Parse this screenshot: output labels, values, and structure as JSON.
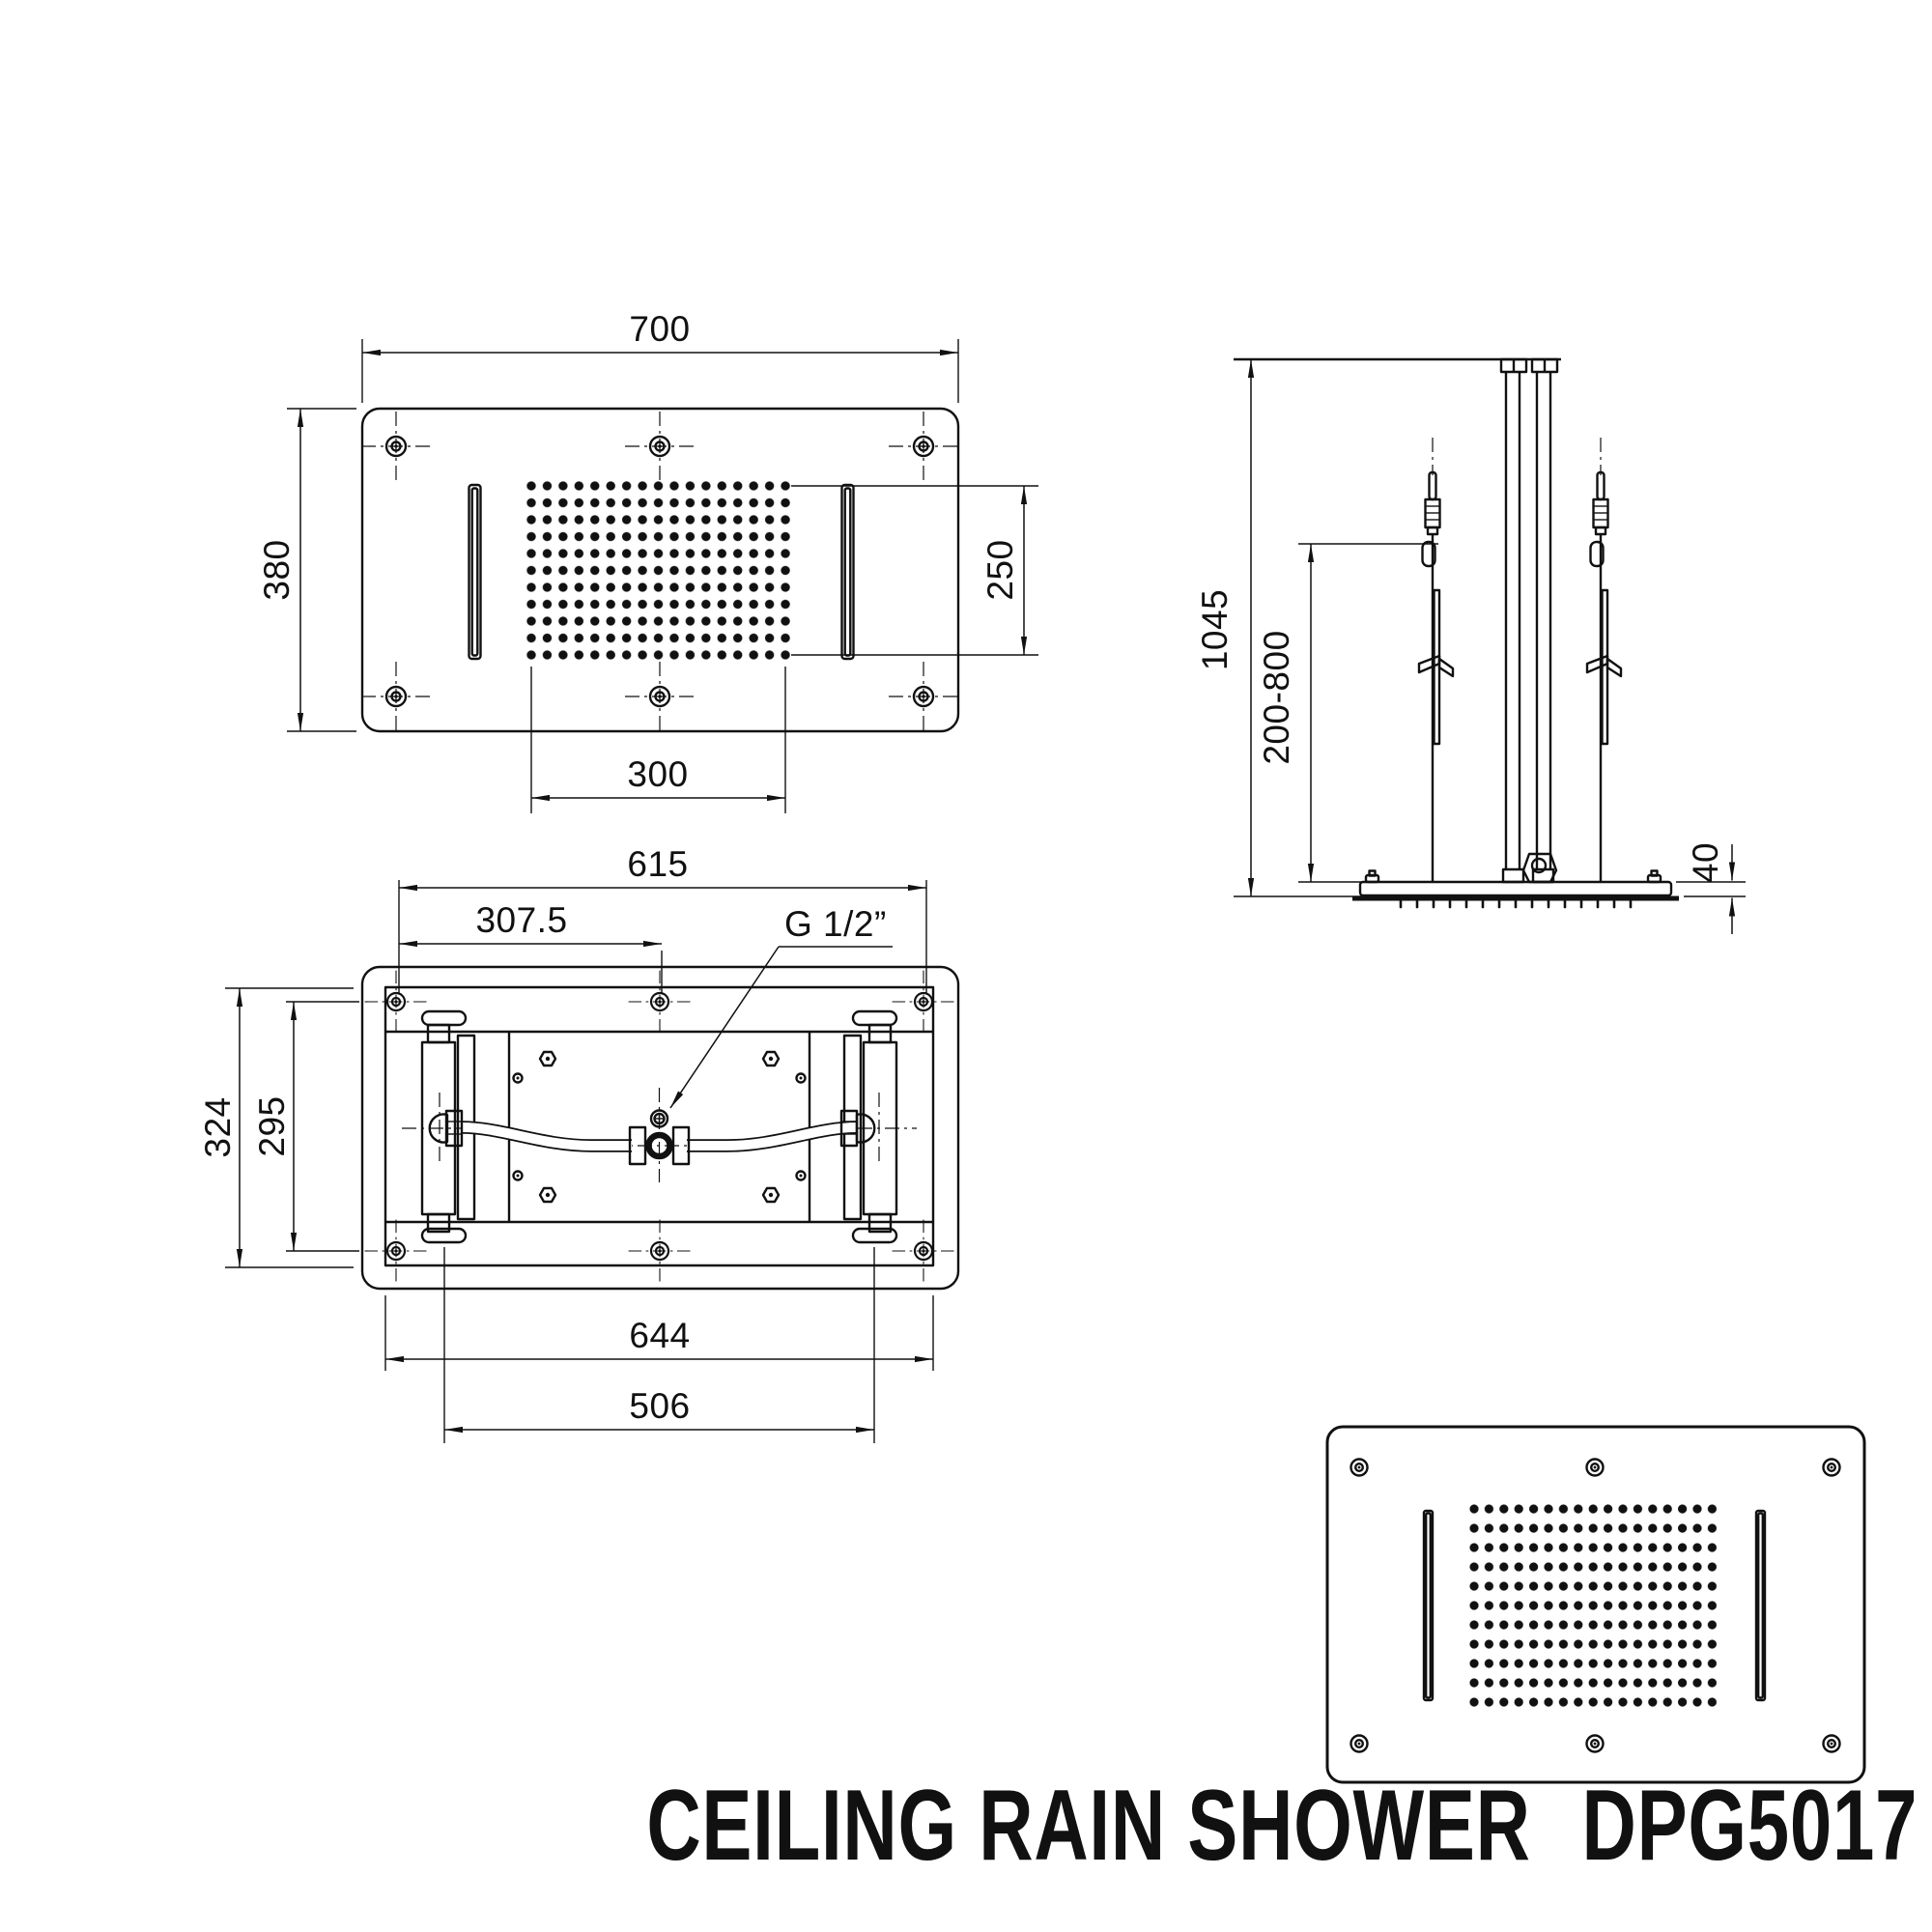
{
  "title": {
    "product": "CEILING RAIN SHOWER",
    "model": "DPG5017"
  },
  "colors": {
    "ink": "#111111",
    "paper": "#ffffff"
  },
  "views": {
    "front": {
      "name": "front view of ceiling shower panel",
      "dims": {
        "overall_width": "700",
        "overall_height": "380",
        "spray_area_height": "250",
        "spray_area_width": "300"
      },
      "spray_grid": {
        "cols": 17,
        "rows": 11
      },
      "mounting_screws": 6,
      "waterfall_slots": 2
    },
    "back": {
      "name": "back view with mounting housing and inlet pipe",
      "dims": {
        "mounting_span": "615",
        "mounting_half_span": "307.5",
        "water_inlet": "G 1/2”",
        "housing_height": "324",
        "screw_row_span": "295",
        "housing_width": "644",
        "bracket_slot_span": "506"
      }
    },
    "side": {
      "name": "side view with suspension rods",
      "dims": {
        "ceiling_to_head": "1045",
        "adjustable_range": "200-800",
        "head_thickness": "40"
      }
    },
    "bottom": {
      "name": "rendered bottom view of shower head",
      "spray_grid": {
        "cols": 17,
        "rows": 11
      }
    }
  }
}
